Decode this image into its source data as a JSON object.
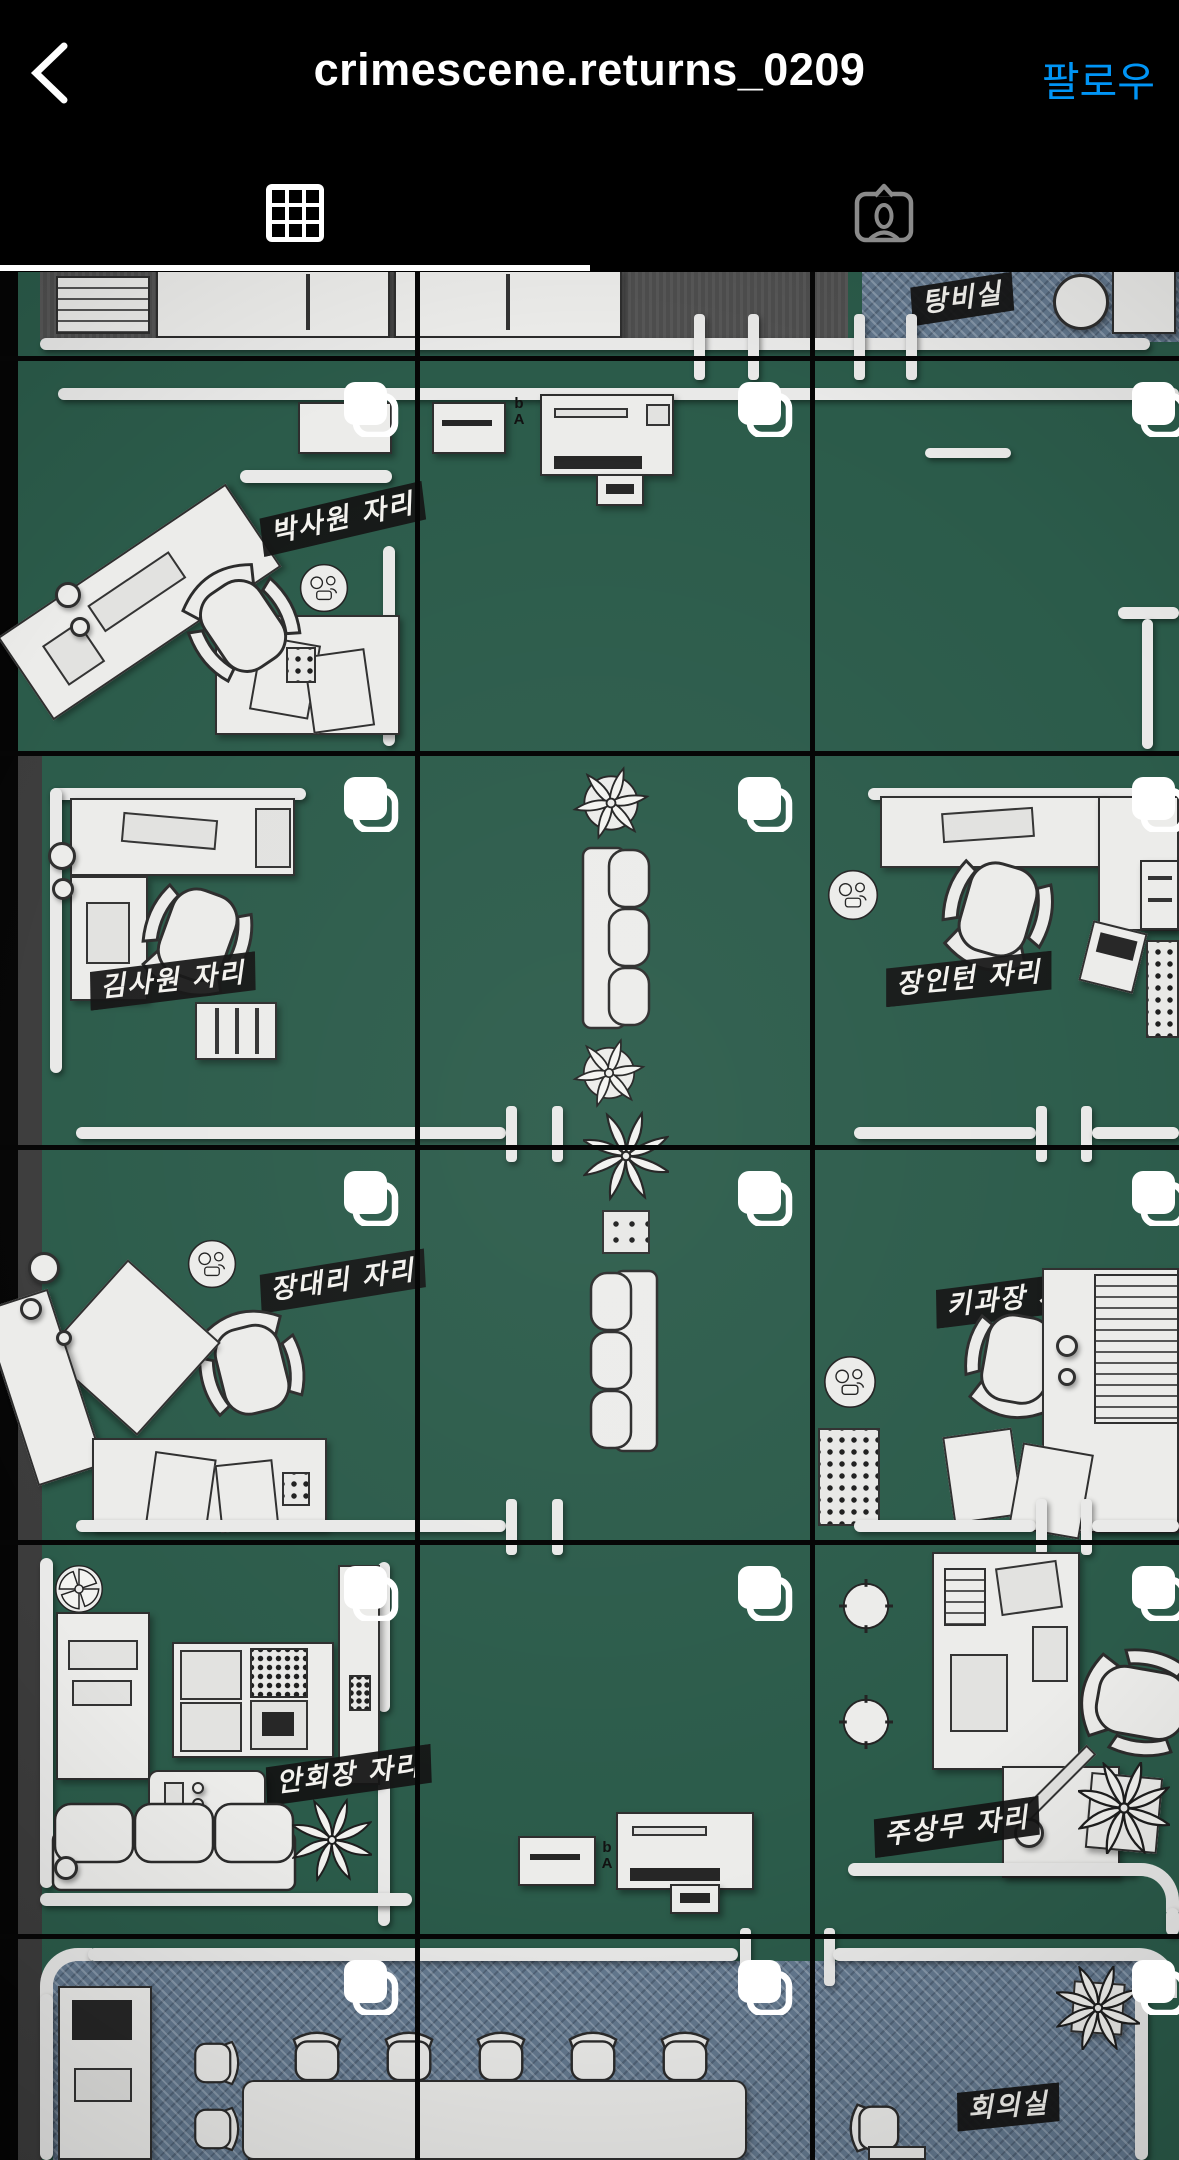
{
  "header": {
    "title": "crimescene.returns_0209",
    "follow_label": "팔로우",
    "accent_color": "#0095F6"
  },
  "tabs": {
    "selected": "posts-grid",
    "items": [
      {
        "id": "posts-grid"
      },
      {
        "id": "tagged"
      }
    ]
  },
  "floorplan_labels": {
    "pantry": "탕비실",
    "seat_park": "박사원 자리",
    "seat_kim": "김사원 자리",
    "seat_jang_intern": "장인턴 자리",
    "seat_jang_daeri": "장대리 자리",
    "seat_ki_gwajang": "키과장 자리",
    "seat_an_hoejang": "안회장 자리",
    "seat_ju_sangmu": "주상무 자리",
    "meeting_room": "회의실"
  },
  "misc": {
    "copier_marks": "b A"
  },
  "colors": {
    "floor_green": "#2b5b4a",
    "denim_blue": "#64798f",
    "carpet_gray": "#4e4e4e",
    "tag_black": "#141414",
    "furniture_white": "#ececea",
    "accent_blue": "#0095F6"
  },
  "icons": {
    "back": "chevron-left-icon",
    "grid_tab": "grid-icon",
    "tagged_tab": "tagged-person-icon",
    "post_badge": "album-icon"
  }
}
